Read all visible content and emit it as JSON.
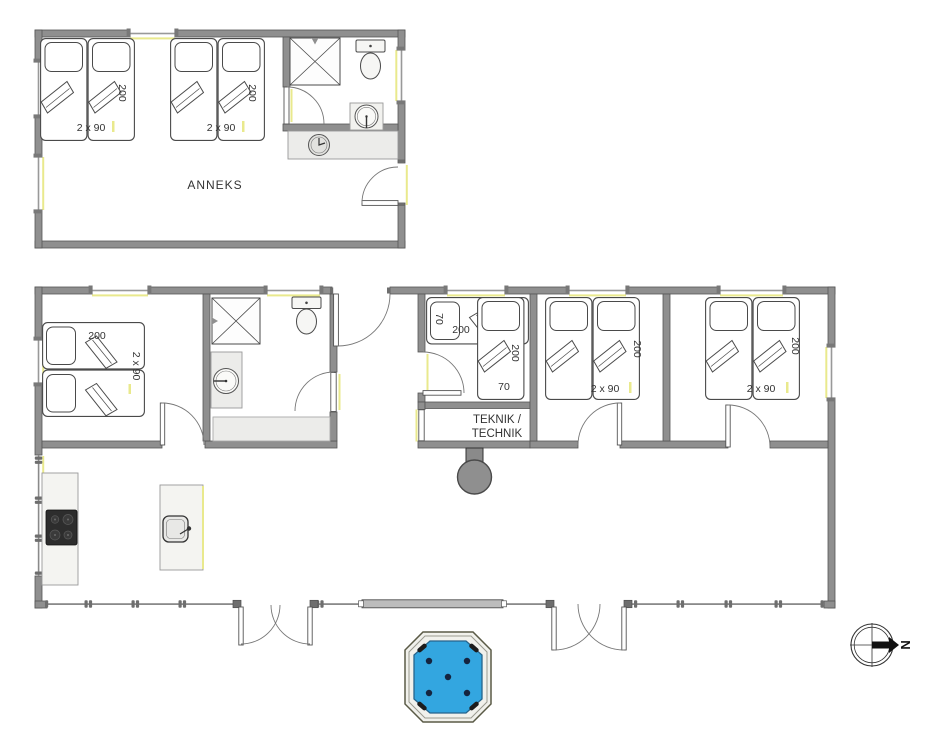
{
  "rooms": {
    "annex": {
      "label": "ANNEKS"
    },
    "technik": {
      "label_line1": "TEKNIK /",
      "label_line2": "TECHNIK"
    }
  },
  "bed_dimensions": {
    "twin_width": "2 x 90",
    "length": "200",
    "single_width": "70"
  },
  "compass": {
    "north_label": "N"
  },
  "colors": {
    "wall": "#8f8f8f",
    "wall_edge": "#565656",
    "window_accent": "#e9e98d",
    "spa_water": "#33a6e0",
    "counter": "#f2f2ef",
    "cooktop": "#2d2d2d"
  }
}
